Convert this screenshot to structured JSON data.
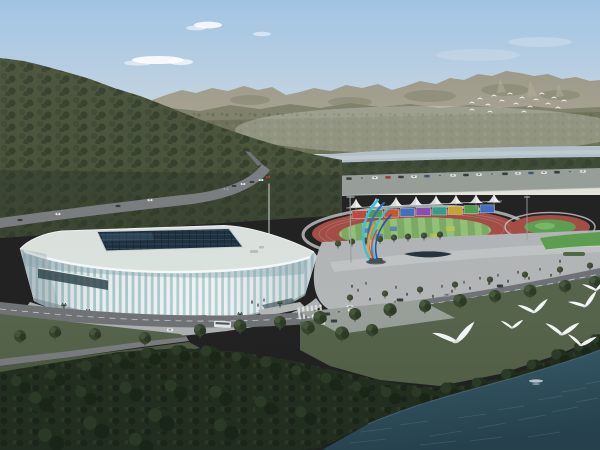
{
  "scene": {
    "type": "architectural-aerial-rendering",
    "description": "Aerial rendering of a white ribbed indoor sports arena with a dark glass roof skylight, next to an outdoor athletics track with colorful billboard panels, a row of white canopy tents and a colorful ribbon sculpture on a plaza; forested mountain ridge and hazy distant mountains behind, a pale river band in the middle distance, roads with cars and a bus, dense dark shoreline trees and a teal lake in the foreground with white gulls flying.",
    "elements": [
      "sky",
      "clouds",
      "far-mountain-ridge",
      "foothills",
      "distant-bird-flock",
      "river",
      "left-forest-ridge",
      "hill-roads",
      "parking-rows",
      "athletics-track",
      "infield",
      "skating-rink",
      "billboard-panels",
      "canopy-tents",
      "ribbon-sculpture",
      "light-masts",
      "plaza",
      "reflecting-pool",
      "pedestrians",
      "lawn",
      "arena-building",
      "roof-skylight",
      "front-road",
      "crosswalk",
      "bus",
      "cars",
      "tree-rows",
      "shoreline-trees",
      "lake-water",
      "boat-wake",
      "foreground-gulls"
    ]
  },
  "palette": {
    "sky-top": "#9cc1e3",
    "sky-mid": "#c6d6e2",
    "sky-horizon": "#e8e6dc",
    "cloud": "#ffffff",
    "far-ridge": "#9b9887",
    "foothill": "#7c8068",
    "plain": "#6e7257",
    "river": "#b2c1c9",
    "river-light": "#c9d4d8",
    "forest": "#49523a",
    "tree-band": "#3f4a36",
    "road": "#7a7e80",
    "road-dark": "#6f7376",
    "parking": "#989e98",
    "track-red": "#a34e46",
    "lane-line": "#c18d82",
    "infield-green-a": "#7dab64",
    "infield-green-b": "#92c277",
    "rink-green": "#5f9e52",
    "tent-white": "#f0f1ef",
    "plaza": "#b2b6b7",
    "plaza-light": "#c6cac9",
    "pool": "#26343c",
    "lawn": "#5d9e50",
    "grass": "#55644a",
    "grass-dark": "#4e5c44",
    "stadium-white": "#e9edef",
    "stadium-roof": "#dce3df",
    "rib-glass": "#a9c9cc",
    "skylight": "#1f3140",
    "skylight-line": "#4a6a80",
    "entry-glass": "#33464e",
    "sculpture-cyan": "#3cc0e6",
    "sculpture-blue": "#2f6fc8",
    "sculpture-deep-blue": "#2456a8",
    "sculpture-orange": "#f09a28",
    "sculpture-red": "#d84a30",
    "water-top": "#3b606f",
    "water-bottom": "#294652",
    "ripple": "#567b8a",
    "wake": "#d7e4e6",
    "bird-white": "#f5f7f7",
    "tree-fg-dark": "#243020",
    "car-white": "#e8eaea",
    "car-dark": "#3a4042",
    "car-red": "#b03a32",
    "car-silver": "#9aa2a4",
    "car-blue": "#45607e",
    "bb0": "#bf4a3e",
    "bb1": "#4f9e4c",
    "bb2": "#c8552f",
    "bb3": "#3f6fc4",
    "bb4": "#8a4fb0",
    "bb5": "#2f9e90",
    "bb6": "#c9a32e",
    "bb7": "#4f9e4c",
    "bb8": "#3f6fc4"
  },
  "counts": {
    "canopy_tents": 8,
    "billboard_panels": 9,
    "foreground_gulls": 7,
    "distant_flock_birds": 18
  }
}
